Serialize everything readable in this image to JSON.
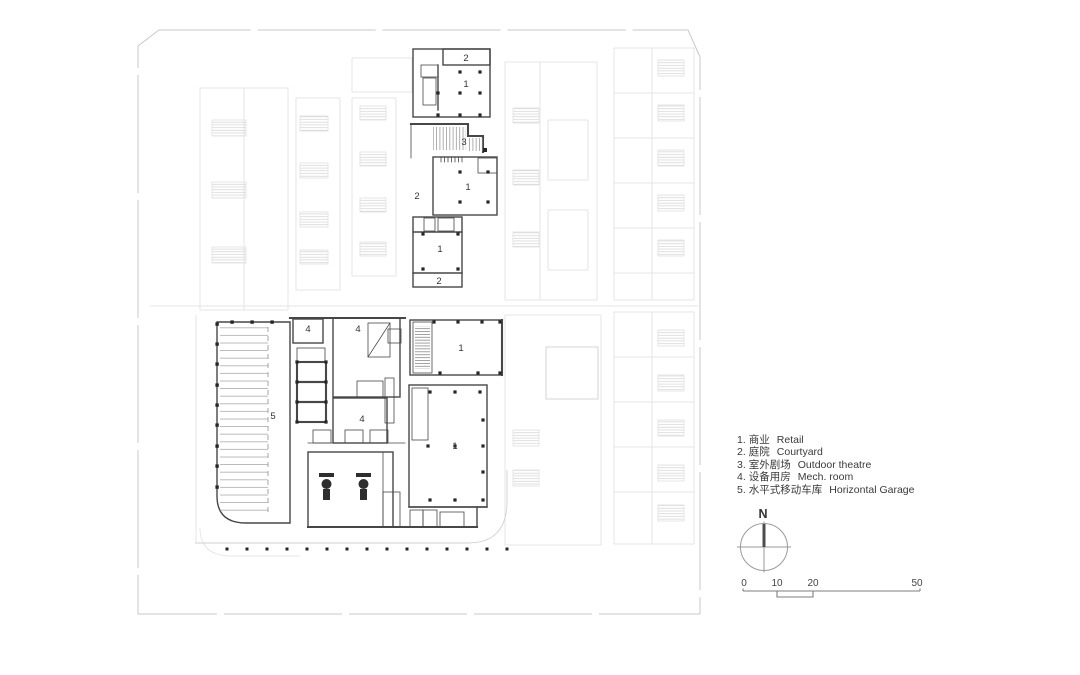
{
  "legend": {
    "items": [
      {
        "num": "1.",
        "zh": "商业",
        "en": "Retail"
      },
      {
        "num": "2.",
        "zh": "庭院",
        "en": "Courtyard"
      },
      {
        "num": "3.",
        "zh": "室外剧场",
        "en": "Outdoor theatre"
      },
      {
        "num": "4.",
        "zh": "设备用房",
        "en": "Mech. room"
      },
      {
        "num": "5.",
        "zh": "水平式移动车库",
        "en": "Horizontal Garage"
      }
    ]
  },
  "compass": {
    "north_label": "N"
  },
  "scalebar": {
    "labels": [
      "0",
      "10",
      "20",
      "50"
    ]
  },
  "plan": {
    "room_labels": [
      {
        "area": "courtyard-north-band",
        "text": "2"
      },
      {
        "area": "retail-north",
        "text": "1"
      },
      {
        "area": "outdoor-theatre",
        "text": "3"
      },
      {
        "area": "courtyard-mid-west",
        "text": "2"
      },
      {
        "area": "retail-mid",
        "text": "1"
      },
      {
        "area": "retail-mid-south",
        "text": "1"
      },
      {
        "area": "courtyard-south-band",
        "text": "2"
      },
      {
        "area": "mech-room-a",
        "text": "4"
      },
      {
        "area": "mech-room-b",
        "text": "4"
      },
      {
        "area": "retail-east",
        "text": "1"
      },
      {
        "area": "horizontal-garage",
        "text": "5"
      },
      {
        "area": "mech-room-c",
        "text": "4"
      },
      {
        "area": "retail-southeast",
        "text": "1"
      }
    ]
  },
  "colors": {
    "wall": "#474747",
    "column": "#262626",
    "context": "#e4e4e4",
    "boundary": "#c8c8c8",
    "text": "#3a3a3a",
    "hatch": "#9a9a9a",
    "background": "#ffffff"
  }
}
